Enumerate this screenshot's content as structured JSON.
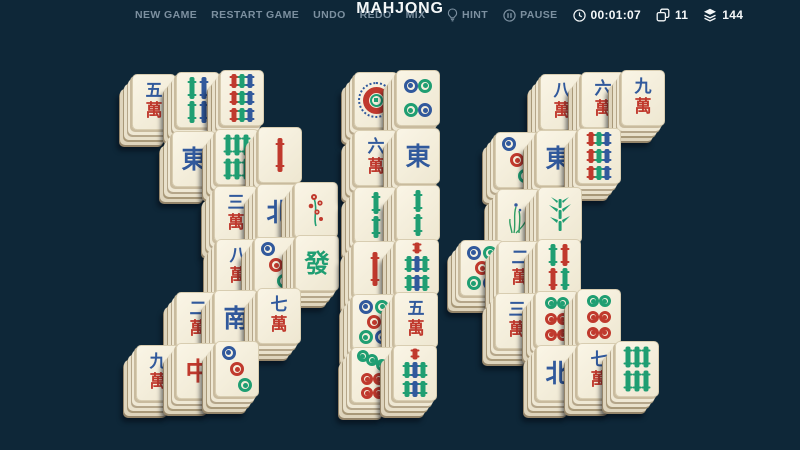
{
  "topbar": {
    "menu": [
      {
        "label": "NEW GAME"
      },
      {
        "label": "RESTART GAME"
      },
      {
        "label": "UNDO"
      },
      {
        "label": "REDO"
      },
      {
        "label": "MIX"
      }
    ],
    "title": "MAHJONG",
    "hint_label": "HINT",
    "pause_label": "PAUSE",
    "timer": "00:01:07",
    "pairs_count": "11",
    "tiles_count": "144"
  },
  "colors": {
    "background": "#0e2738",
    "menu_text": "#7c90a0",
    "white_text": "#f4f7f8",
    "tile_face": "#f2ecd9",
    "tile_edge": "#b5a68a",
    "suit": {
      "b": "#31599c",
      "r": "#c0392d",
      "g": "#1f9e72"
    }
  },
  "board": {
    "tiles": [
      {
        "name": "5-wan",
        "t": "char",
        "top": "五",
        "bot": "萬",
        "x": 132,
        "y": 74
      },
      {
        "name": "4-bamboo",
        "t": "bam",
        "n": 4,
        "colors": [
          "g",
          "b",
          "g",
          "b"
        ],
        "x": 176,
        "y": 72
      },
      {
        "name": "9-bamboo",
        "t": "bam",
        "n": 9,
        "colors": [
          "r",
          "g",
          "b",
          "r",
          "g",
          "b",
          "r",
          "g",
          "b"
        ],
        "x": 220,
        "y": 70
      },
      {
        "name": "east-wind",
        "t": "big",
        "ch": "東",
        "c": "b",
        "x": 172,
        "y": 131
      },
      {
        "name": "6-bamboo",
        "t": "bam",
        "n": 6,
        "colors": [
          "g",
          "g",
          "g",
          "g",
          "g",
          "g"
        ],
        "x": 215,
        "y": 129
      },
      {
        "name": "1-bamboo",
        "t": "bam",
        "n": 1,
        "colors": [
          "r"
        ],
        "x": 258,
        "y": 127
      },
      {
        "name": "3-wan",
        "t": "char",
        "top": "三",
        "bot": "萬",
        "x": 214,
        "y": 186
      },
      {
        "name": "north-wind",
        "t": "big",
        "ch": "北",
        "c": "b",
        "x": 257,
        "y": 184
      },
      {
        "name": "plum-flower",
        "t": "flower",
        "kind": "plum",
        "x": 294,
        "y": 182
      },
      {
        "name": "8-wan",
        "t": "char",
        "top": "八",
        "bot": "萬",
        "x": 216,
        "y": 239
      },
      {
        "name": "3-dots",
        "t": "dots",
        "n": 3,
        "colors": [
          "b",
          "r",
          "g"
        ],
        "x": 254,
        "y": 237
      },
      {
        "name": "green-dragon",
        "t": "big",
        "ch": "發",
        "c": "g",
        "x": 295,
        "y": 235
      },
      {
        "name": "2-wan",
        "t": "char",
        "top": "二",
        "bot": "萬",
        "x": 176,
        "y": 292
      },
      {
        "name": "south-wind",
        "t": "big",
        "ch": "南",
        "c": "b",
        "x": 214,
        "y": 290
      },
      {
        "name": "7-wan",
        "t": "char",
        "top": "七",
        "bot": "萬",
        "x": 257,
        "y": 288
      },
      {
        "name": "9-wan",
        "t": "char",
        "top": "九",
        "bot": "萬",
        "x": 136,
        "y": 345
      },
      {
        "name": "red-dragon",
        "t": "big",
        "ch": "中",
        "c": "r",
        "x": 176,
        "y": 343
      },
      {
        "name": "3-dots",
        "t": "dots",
        "n": 3,
        "colors": [
          "b",
          "r",
          "g"
        ],
        "x": 215,
        "y": 341
      },
      {
        "name": "1-dot",
        "t": "dots",
        "n": 1,
        "colors": [],
        "x": 354,
        "y": 72
      },
      {
        "name": "4-dots",
        "t": "dots",
        "n": 4,
        "colors": [
          "b",
          "g",
          "g",
          "b"
        ],
        "x": 396,
        "y": 70
      },
      {
        "name": "6-wan",
        "t": "char",
        "top": "六",
        "bot": "萬",
        "x": 354,
        "y": 130
      },
      {
        "name": "east-wind",
        "t": "big",
        "ch": "東",
        "c": "b",
        "x": 396,
        "y": 128
      },
      {
        "name": "2-bamboo",
        "t": "bam",
        "n": 2,
        "colors": [
          "g",
          "g"
        ],
        "x": 354,
        "y": 187
      },
      {
        "name": "2-bamboo",
        "t": "bam",
        "n": 2,
        "colors": [
          "g",
          "g"
        ],
        "x": 396,
        "y": 185
      },
      {
        "name": "1-bamboo",
        "t": "bam",
        "n": 1,
        "colors": [
          "r"
        ],
        "x": 353,
        "y": 241
      },
      {
        "name": "7-bamboo",
        "t": "bam",
        "n": 7,
        "colors": [
          "r",
          "g",
          "b",
          "g",
          "g",
          "b",
          "g"
        ],
        "x": 395,
        "y": 239
      },
      {
        "name": "5-dots",
        "t": "dots",
        "n": 5,
        "colors": [
          "b",
          "g",
          "r",
          "g",
          "b"
        ],
        "x": 352,
        "y": 294
      },
      {
        "name": "5-wan",
        "t": "char",
        "top": "五",
        "bot": "萬",
        "x": 394,
        "y": 292
      },
      {
        "name": "7-dots",
        "t": "dots",
        "n": 7,
        "colors": [
          "g",
          "g",
          "g",
          "r",
          "r",
          "r",
          "r"
        ],
        "x": 351,
        "y": 347
      },
      {
        "name": "7-bamboo",
        "t": "bam",
        "n": 7,
        "colors": [
          "r",
          "g",
          "b",
          "g",
          "g",
          "b",
          "g"
        ],
        "x": 393,
        "y": 345
      },
      {
        "name": "8-wan",
        "t": "char",
        "top": "八",
        "bot": "萬",
        "x": 540,
        "y": 74
      },
      {
        "name": "6-wan",
        "t": "char",
        "top": "六",
        "bot": "萬",
        "x": 581,
        "y": 72
      },
      {
        "name": "9-wan",
        "t": "char",
        "top": "九",
        "bot": "萬",
        "x": 621,
        "y": 70
      },
      {
        "name": "3-dots",
        "t": "dots",
        "n": 3,
        "colors": [
          "b",
          "r",
          "g"
        ],
        "x": 495,
        "y": 132
      },
      {
        "name": "east-wind",
        "t": "big",
        "ch": "東",
        "c": "b",
        "x": 536,
        "y": 130
      },
      {
        "name": "9-bamboo",
        "t": "bam",
        "n": 9,
        "colors": [
          "r",
          "g",
          "b",
          "r",
          "g",
          "b",
          "r",
          "g",
          "b"
        ],
        "x": 577,
        "y": 128
      },
      {
        "name": "orchid-flower",
        "t": "flower",
        "kind": "orchid",
        "x": 497,
        "y": 189
      },
      {
        "name": "bamboo-flower",
        "t": "flower",
        "kind": "bamboo",
        "x": 538,
        "y": 187
      },
      {
        "name": "5-dots",
        "t": "dots",
        "n": 5,
        "colors": [
          "b",
          "g",
          "r",
          "g",
          "b"
        ],
        "x": 460,
        "y": 240
      },
      {
        "name": "2-wan",
        "t": "char",
        "top": "二",
        "bot": "萬",
        "x": 498,
        "y": 241
      },
      {
        "name": "4-bamboo",
        "t": "bam",
        "n": 4,
        "colors": [
          "g",
          "r",
          "r",
          "g"
        ],
        "x": 537,
        "y": 239
      },
      {
        "name": "3-wan",
        "t": "char",
        "top": "三",
        "bot": "萬",
        "x": 495,
        "y": 293
      },
      {
        "name": "6-dots",
        "t": "dots",
        "n": 6,
        "colors": [
          "g",
          "g",
          "r",
          "r",
          "r",
          "r"
        ],
        "x": 535,
        "y": 291
      },
      {
        "name": "6-dots",
        "t": "dots",
        "n": 6,
        "colors": [
          "g",
          "g",
          "r",
          "r",
          "r",
          "r"
        ],
        "x": 577,
        "y": 289
      },
      {
        "name": "north-wind",
        "t": "big",
        "ch": "北",
        "c": "b",
        "x": 536,
        "y": 345
      },
      {
        "name": "7-wan",
        "t": "char",
        "top": "七",
        "bot": "萬",
        "x": 577,
        "y": 343
      },
      {
        "name": "6-bamboo",
        "t": "bam",
        "n": 6,
        "colors": [
          "g",
          "g",
          "g",
          "g",
          "g",
          "g"
        ],
        "x": 615,
        "y": 341
      }
    ]
  }
}
